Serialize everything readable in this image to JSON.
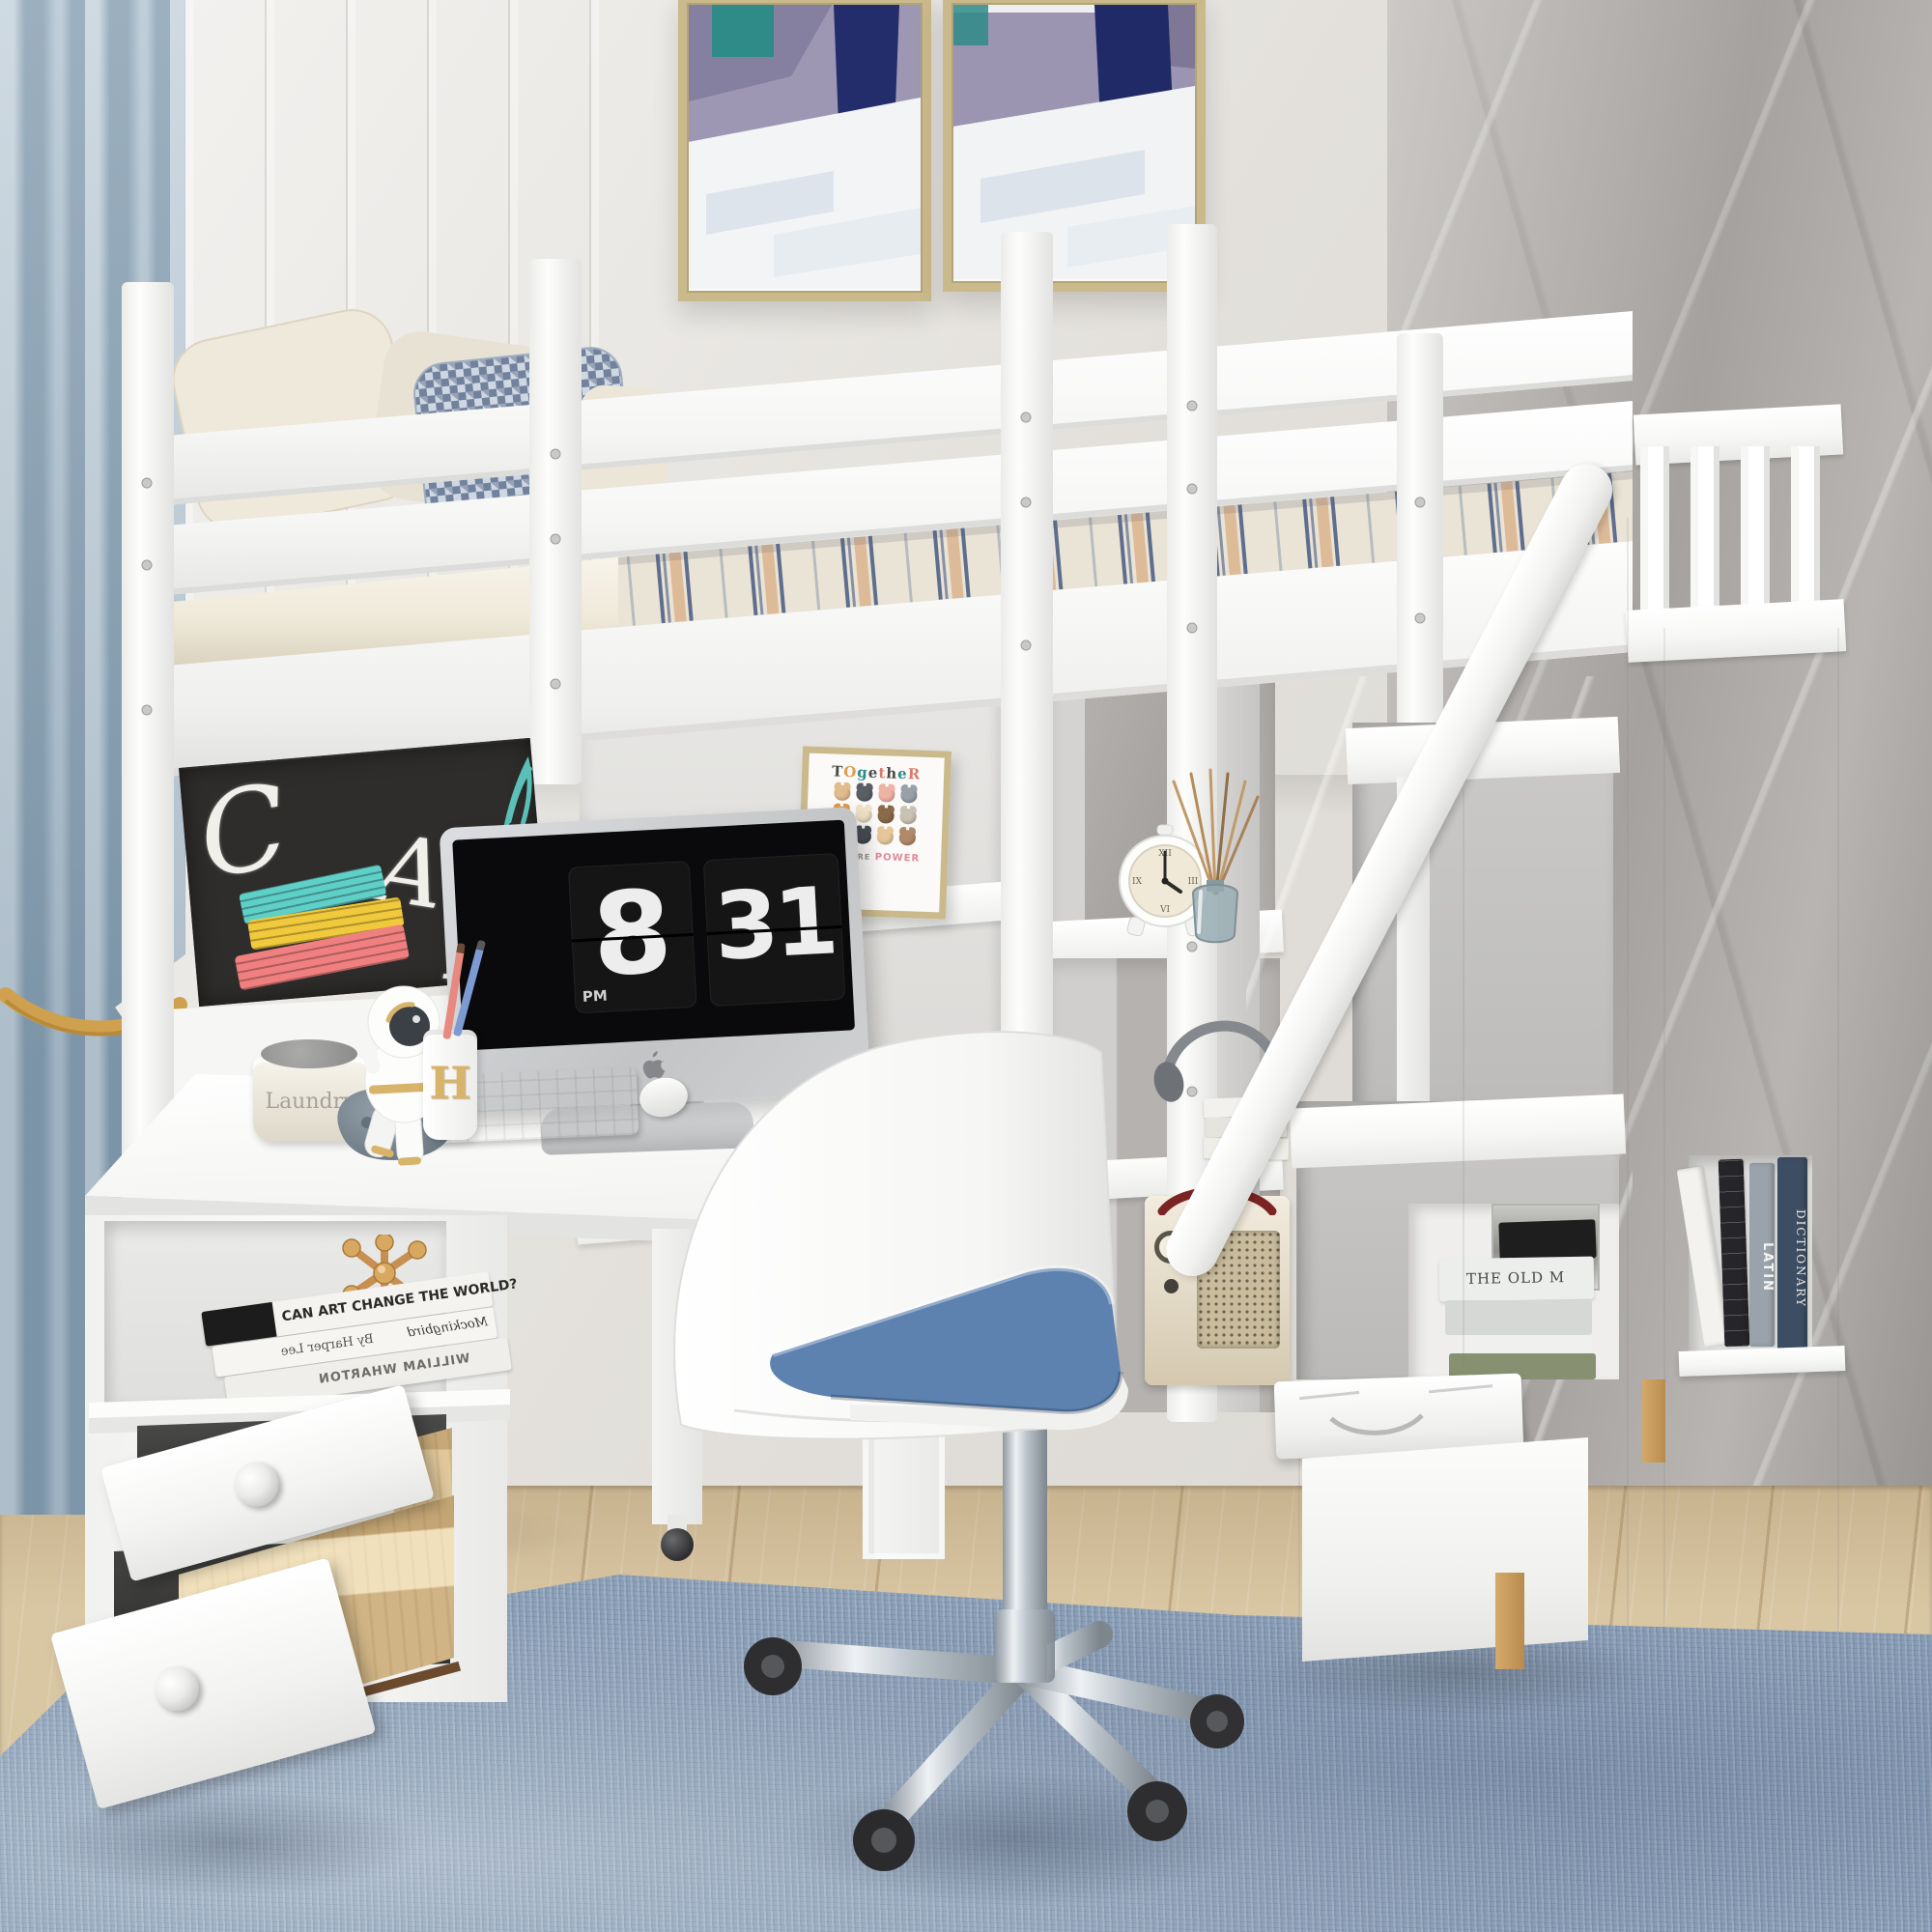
{
  "scene": {
    "subject": "White loft bed with desk, storage staircase, chalkboard and office chair in a kids bedroom"
  },
  "palette": {
    "furniture_white": "#fafaf8",
    "wall_left": "#eae8e4",
    "wall_marble": "#aca9a6",
    "curtain_blue": "#a4b9c8",
    "tieback_gold": "#cfa14e",
    "rug_blue": "#8da1b9",
    "floor_wood": "#d9c6a3",
    "chalkboard_black": "#2e2d2b",
    "seat_blue": "#5d82b0",
    "chrome_silver": "#b9c0c8",
    "caster_black": "#2e2e30",
    "frame_gold": "#c9b98b",
    "plywood_tan": "#e0c89c",
    "gold_accent": "#d8b36a"
  },
  "paintings": {
    "lavender": "#9d97b4",
    "purple": "#837d9d",
    "navy": "#232d6c",
    "teal": "#2f8b88",
    "white": "#f3f4f6"
  },
  "chalkboard": {
    "letters": [
      "C",
      "A",
      "×",
      "B"
    ],
    "book_colors": [
      "#5fd0c8",
      "#f1c93c",
      "#f08080"
    ]
  },
  "imac": {
    "hour": "8",
    "minute": "31",
    "meridiem": "PM"
  },
  "desk_items": {
    "basket_label": "Laundry",
    "pen_letter": "H"
  },
  "frame_art": {
    "letters": [
      "T",
      "O",
      "g",
      "e",
      "t",
      "h",
      "e",
      "R"
    ],
    "letter_colors": [
      "#4a4a48",
      "#e09a4e",
      "#2e8b89",
      "#4a4a48",
      "#d97b6e",
      "#4a4a48",
      "#2e8b89",
      "#d97b6e"
    ],
    "cat_colors": [
      "#e3bc8e",
      "#5a5f66",
      "#eeb3a4",
      "#9aa0a8",
      "#e09a4e",
      "#f0e2c8",
      "#8a6a4a",
      "#c9c2b4",
      "#d98a6a",
      "#4a4f55",
      "#e8c89a",
      "#b08968"
    ],
    "subtitle": [
      "WE",
      "ARE",
      "POWER"
    ],
    "subtitle_colors": [
      "#2e8b89",
      "#9a948a",
      "#e08a9a"
    ]
  },
  "alarm_clock": {
    "n12": "XII",
    "n3": "III",
    "n6": "VI",
    "n9": "IX"
  },
  "cabinet_books": {
    "top": "CAN ART CHANGE THE WORLD?",
    "middle": "By Harper Lee",
    "middle_right": "Mockingbird",
    "bottom": "WILLIAM WHARTON"
  },
  "stair_cubby": {
    "spine": "THE OLD M",
    "spine_colors": [
      "#1e1e1e",
      "#eceeec",
      "#d6d8d6",
      "#f0f0ee",
      "#879070"
    ]
  },
  "column_books": {
    "titles": [
      "",
      "",
      "LATIN",
      "DICTIONARY"
    ],
    "colors": [
      "#f3f2ef",
      "#26262a",
      "#9aa3ab",
      "#3d4d63"
    ],
    "text_colors": [
      "#777777",
      "#cfcfcf",
      "#f5f5f2",
      "#e8e6df"
    ]
  },
  "radio": {
    "body": "#e9dfc9",
    "accent": "#7c2424",
    "grille": "#c9bc9c"
  }
}
